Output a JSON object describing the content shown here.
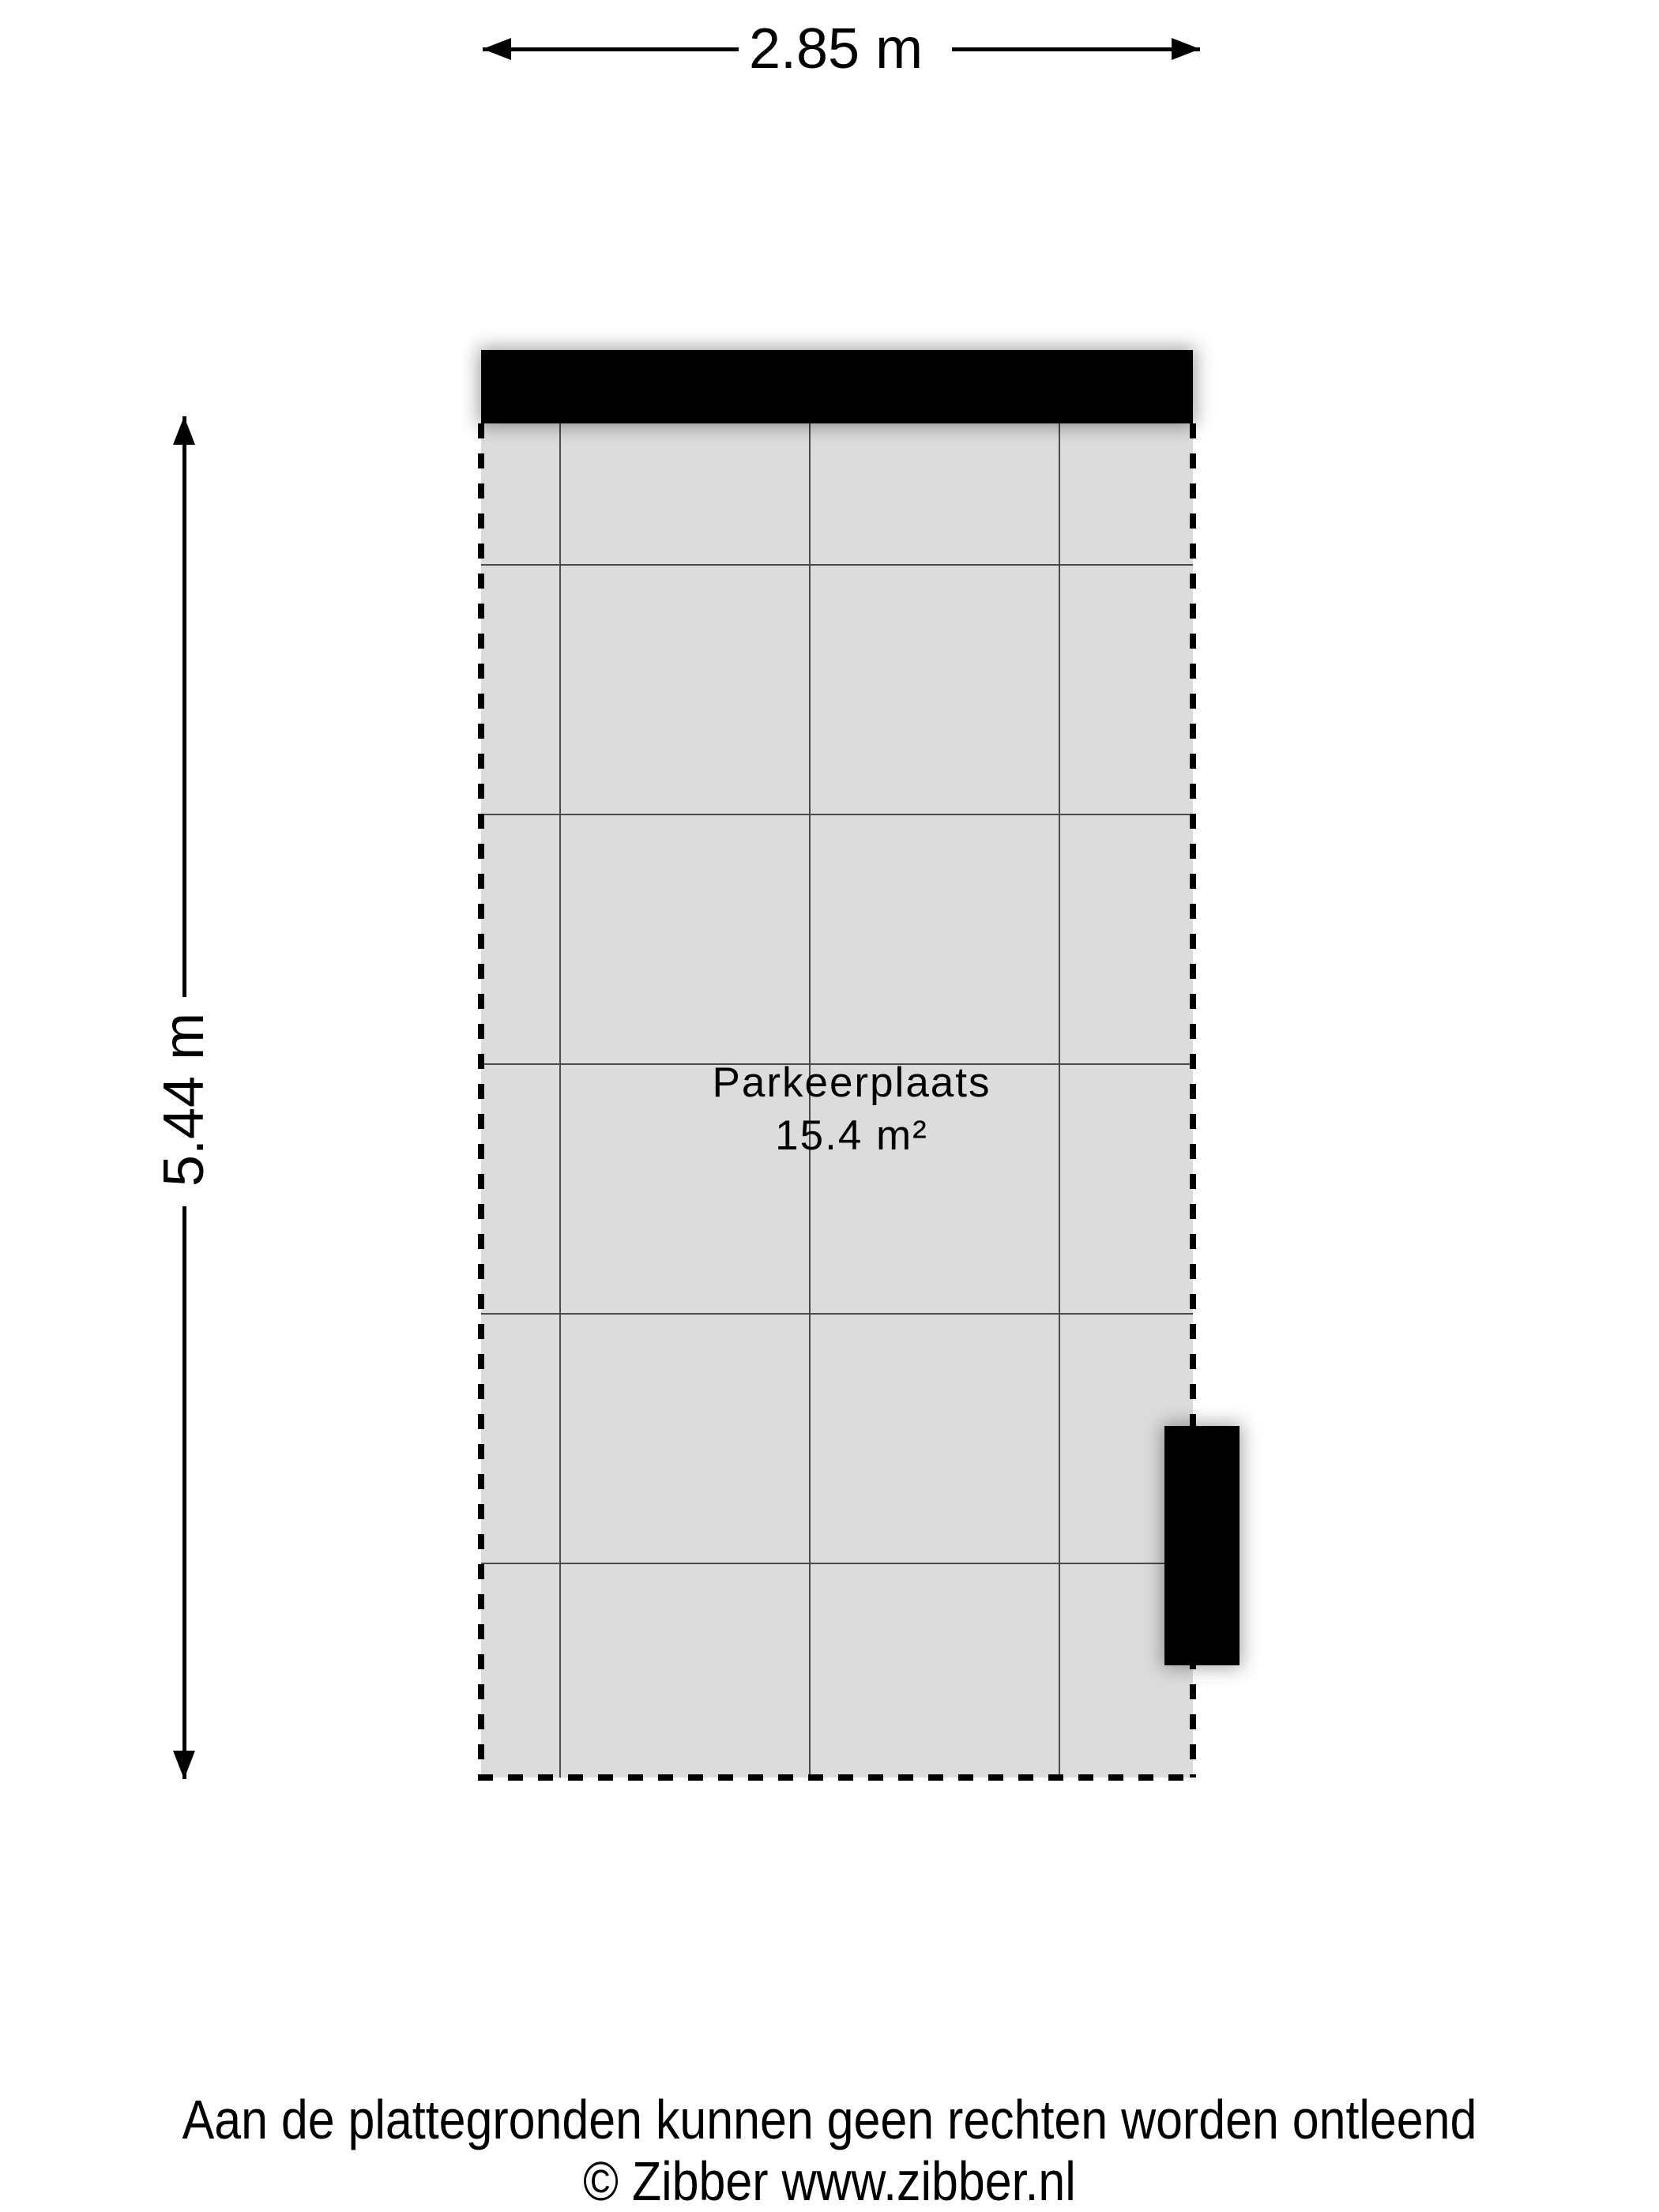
{
  "dimensions": {
    "width_label": "2.85 m",
    "height_label": "5.44 m"
  },
  "room": {
    "name": "Parkeerplaats",
    "area": "15.4 m²"
  },
  "footer": {
    "disclaimer": "Aan de plattegronden kunnen geen rechten worden ontleend",
    "copyright": "© Zibber www.zibber.nl"
  },
  "colors": {
    "floor_fill": "#dcdcdc",
    "grid_line": "#4a4a4a",
    "wall": "#000000",
    "ink": "#000000"
  }
}
